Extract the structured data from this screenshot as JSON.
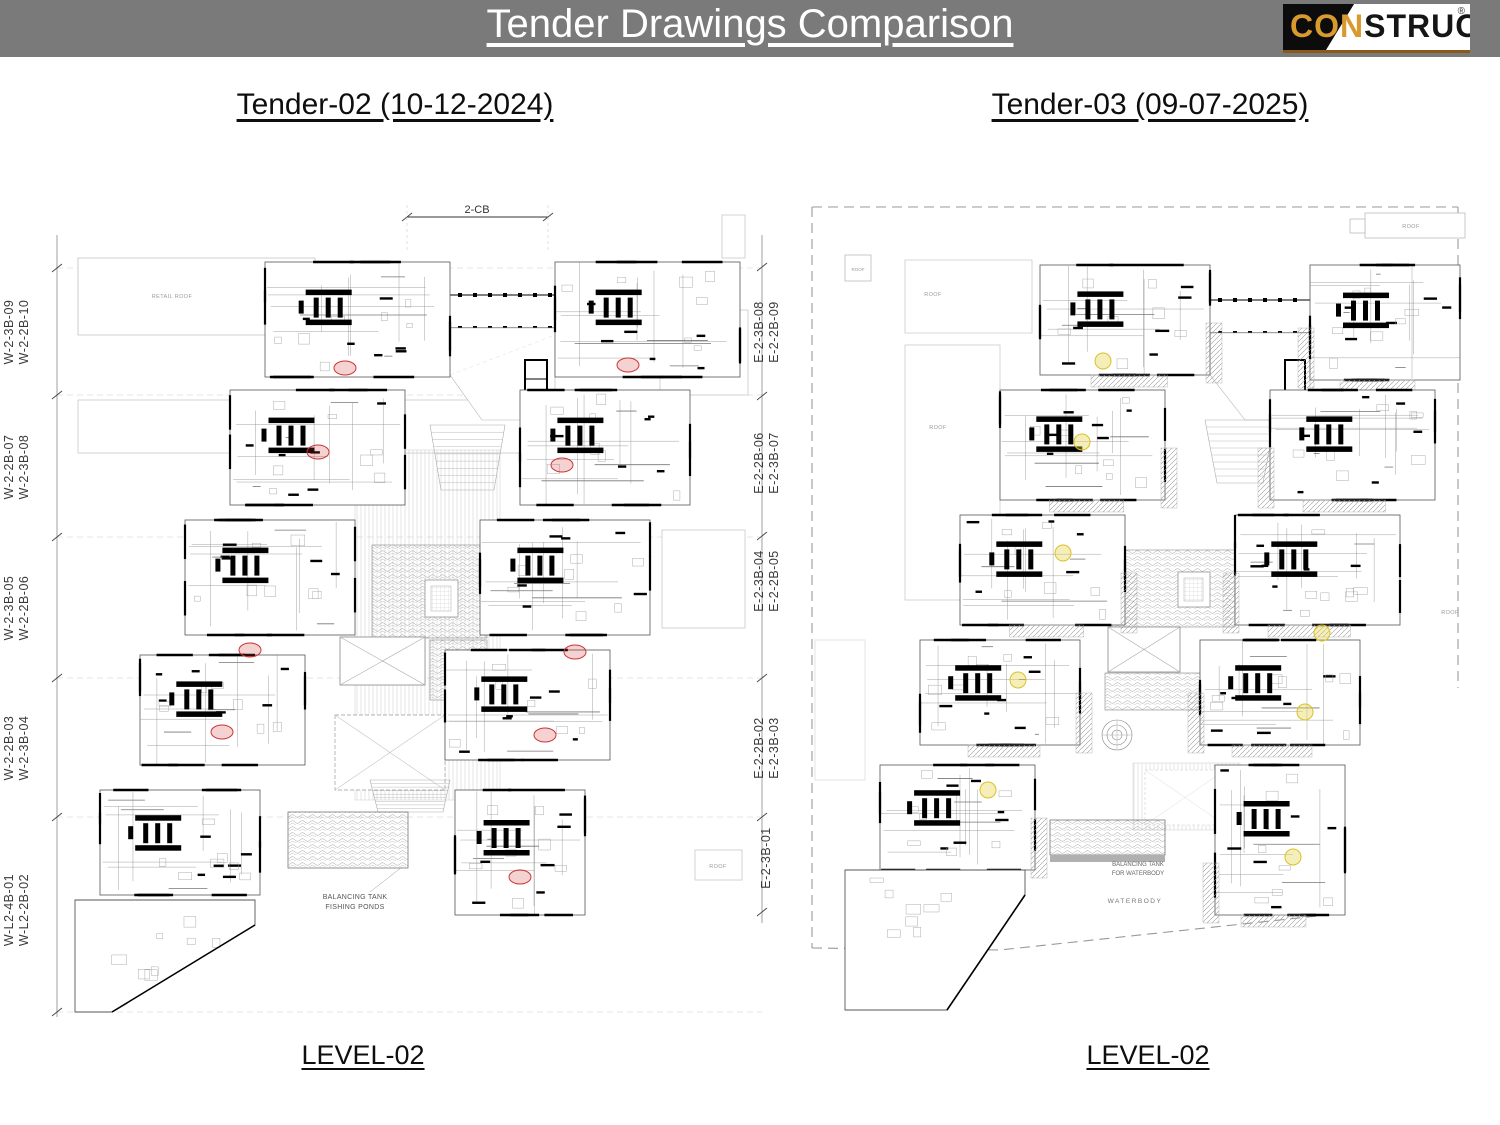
{
  "header": {
    "title": "Tender Drawings Comparison",
    "logo": {
      "left": "CON",
      "right": "STRUCT",
      "registered": "®"
    }
  },
  "panels": {
    "left": {
      "heading": "Tender-02 (10-12-2024)",
      "level": "LEVEL-02",
      "dimension_label": "2-CB",
      "west_grid_labels": [
        [
          "W-2-3B-09",
          "W-2-2B-10"
        ],
        [
          "W-2-2B-07",
          "W-2-3B-08"
        ],
        [
          "W-2-3B-05",
          "W-2-2B-06"
        ],
        [
          "W-2-2B-03",
          "W-2-3B-04"
        ],
        [
          "W-L2-4B-01",
          "W-L2-2B-02"
        ]
      ],
      "east_grid_labels": [
        [
          "E-2-3B-08",
          "E-2-2B-09"
        ],
        [
          "E-2-2B-06",
          "E-2-3B-07"
        ],
        [
          "E-2-3B-04",
          "E-2-2B-05"
        ],
        [
          "E-2-2B-02",
          "E-2-3B-03"
        ],
        [
          "E-2-3B-01"
        ]
      ],
      "annotations": {
        "retail_roof": "RETAIL ROOF",
        "roof": "ROOF",
        "tank_line1": "BALANCING TANK",
        "tank_line2": "FISHING PONDS"
      }
    },
    "right": {
      "heading": "Tender-03 (09-07-2025)",
      "level": "LEVEL-02",
      "annotations": {
        "roof": "ROOF",
        "tank_line1": "BALANCING TANK",
        "tank_line2": "FOR WATERBODY",
        "waterbody": "WATERBODY"
      }
    }
  },
  "colors": {
    "header_bg": "#7a7a7a",
    "logo_orange": "#d8992f",
    "highlight_red": "#cc3333",
    "highlight_yellow": "#e0cc4a",
    "drawing_line": "#000000"
  }
}
